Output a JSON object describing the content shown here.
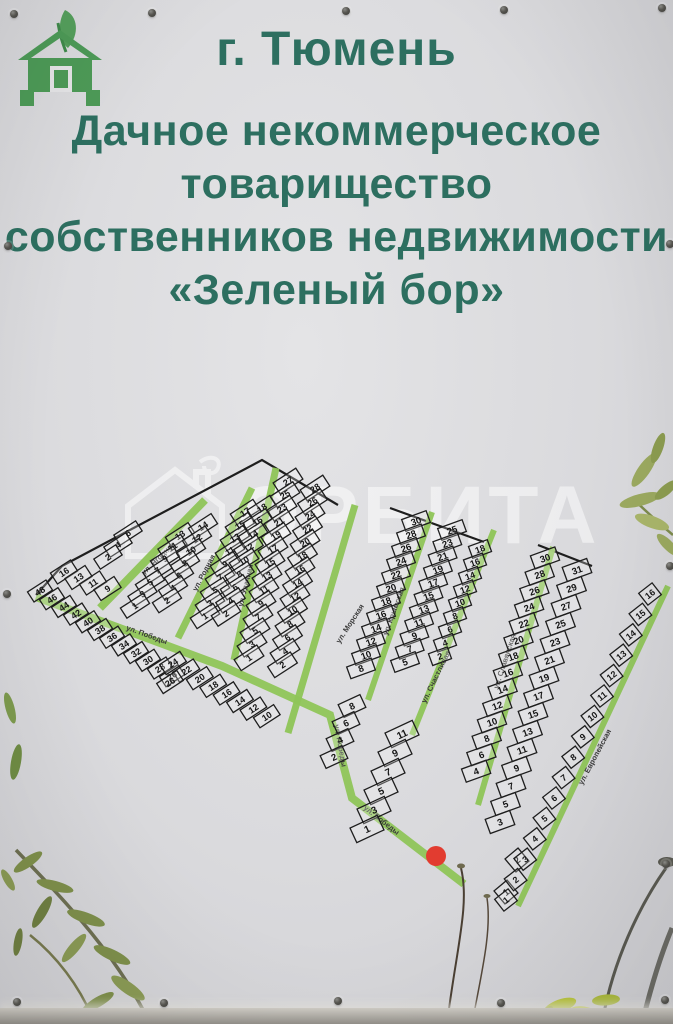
{
  "header": {
    "city": "г. Тюмень",
    "org_line1": "Дачное некоммерческое",
    "org_line2": "товарищество",
    "org_line3": "собственников недвижимости",
    "org_line4": "«Зеленый бор»"
  },
  "logo": {
    "description": "green house with leaf"
  },
  "watermark": {
    "text": "ОРБИТА"
  },
  "colors": {
    "heading_green": "#2d6f60",
    "logo_green": "#4d9a57",
    "street_green": "#8fc558",
    "map_line": "#1e1e1e",
    "marker_red": "#e23c30"
  },
  "map": {
    "marker": {
      "type": "red-location-dot"
    },
    "streets": {
      "yagodnaya": "ул. Ягодная",
      "rodnaya": "ул. Родная",
      "udachnaya": "ул. Удачная",
      "morskaya": "ул. Морская",
      "pobedy": "ул. Победы",
      "krymskaya": "ул. Крымская",
      "schastlivaya": "ул. Счастливая",
      "slavyanskaya": "ул. Славянская",
      "evropeyskaya": "ул. Европейская"
    },
    "blocks": {
      "west": {
        "corner": [
          16,
          13,
          11,
          9
        ],
        "edge": [
          48,
          46,
          44,
          42,
          40,
          38,
          36,
          34,
          32,
          30,
          28,
          26
        ],
        "top_small": [
          6,
          4,
          2
        ],
        "c1": [
          13,
          11,
          9,
          7,
          5,
          3,
          1
        ],
        "c2": [
          14,
          12,
          10,
          8,
          6,
          4,
          2
        ],
        "c3": [
          17,
          15,
          13,
          11,
          9,
          7,
          5,
          3,
          1
        ],
        "c4": [
          18,
          16,
          14,
          12,
          10,
          8,
          6,
          4,
          2
        ],
        "c5": [
          27,
          25,
          23,
          21,
          19,
          17,
          15,
          13,
          11,
          9,
          7,
          5,
          3,
          1
        ],
        "c6": [
          28,
          26,
          24,
          22,
          20,
          18,
          16,
          14,
          12,
          10,
          8,
          6,
          4,
          2
        ],
        "bottom_row": [
          24,
          22,
          20,
          18,
          16,
          14,
          12,
          10
        ],
        "lone": [
          26
        ]
      },
      "block1": {
        "a": [
          30,
          28,
          26,
          24,
          22,
          20,
          18,
          16,
          14,
          12,
          10,
          8
        ],
        "b": [
          25,
          23,
          21,
          19,
          17,
          15,
          13,
          11,
          9,
          7,
          5
        ],
        "c": [
          18,
          16,
          14,
          12,
          10,
          8,
          6,
          4,
          2
        ],
        "bottom_odd": [
          11,
          9,
          7,
          5,
          3,
          1
        ],
        "bottom_even": [
          8,
          6,
          4,
          2
        ]
      },
      "block2": {
        "a": [
          30,
          28,
          26,
          24,
          22,
          20,
          18,
          16,
          14,
          12,
          10,
          8,
          6,
          4
        ],
        "b": [
          31,
          29,
          27,
          25,
          23,
          21,
          19,
          17,
          15,
          13,
          11,
          9,
          7,
          5,
          3
        ],
        "bottom": [
          2,
          1
        ]
      },
      "east": {
        "a": [
          16,
          15,
          14,
          13,
          12,
          11,
          10,
          9,
          8,
          7,
          6,
          5,
          4,
          3,
          2,
          1
        ]
      }
    }
  }
}
